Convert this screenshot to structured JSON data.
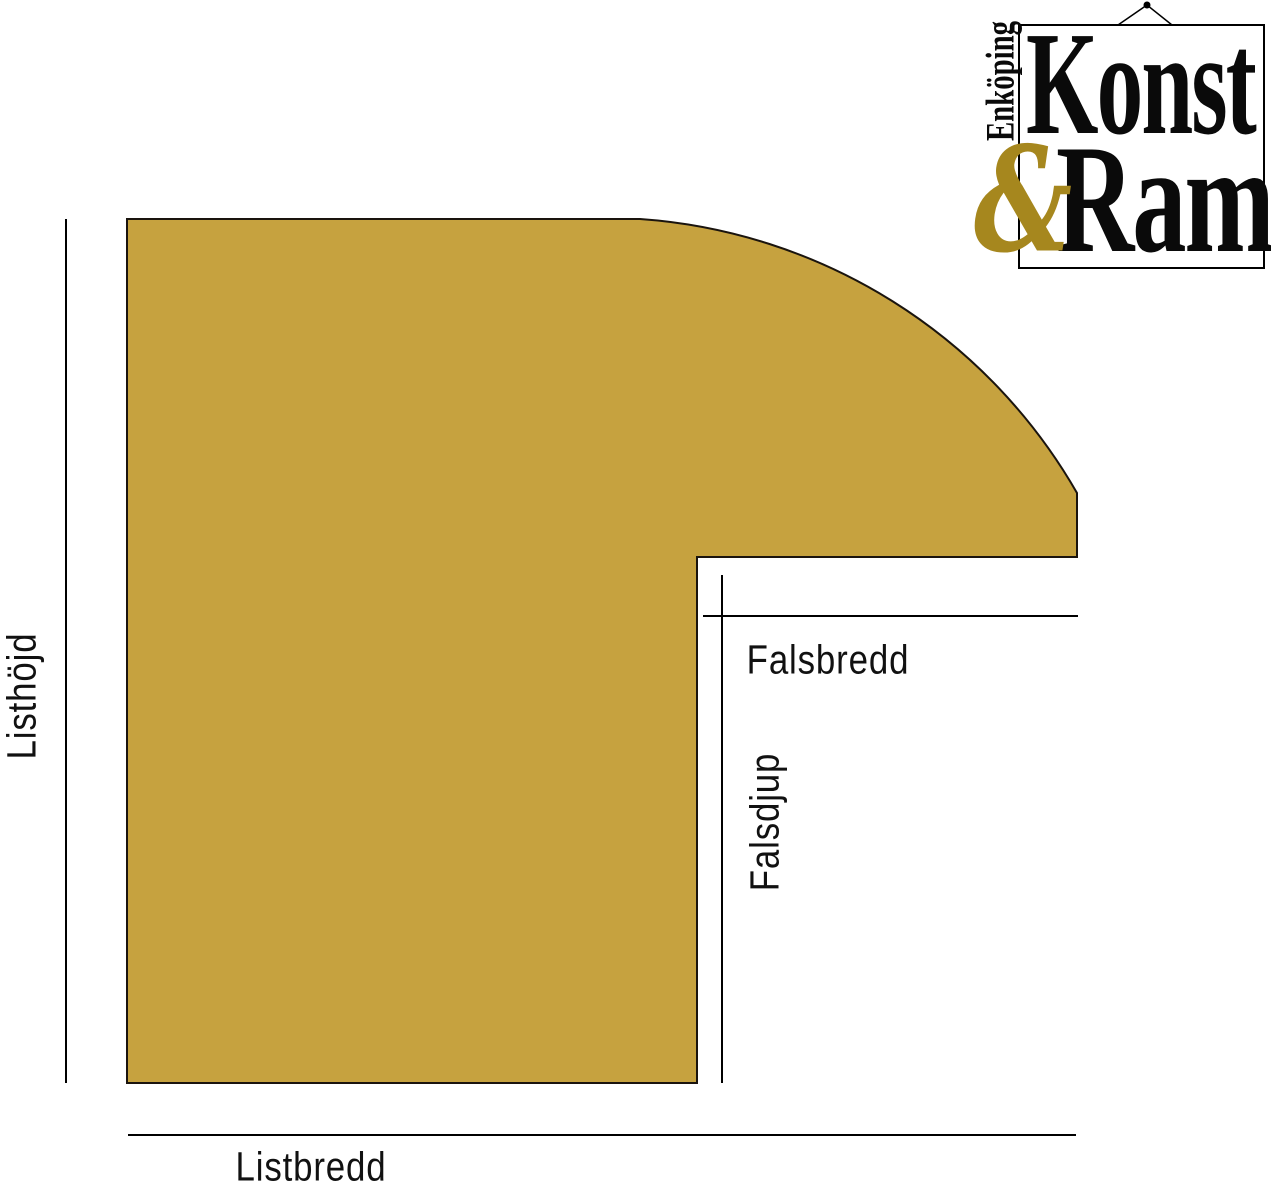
{
  "diagram": {
    "shape_color": "#C6A23F",
    "outline_color": "#1A140E",
    "line_color": "#000000",
    "text_color": "#111111",
    "labels": {
      "height": "Listhöjd",
      "width": "Listbredd",
      "rebate_width": "Falsbredd",
      "rebate_depth": "Falsdjup"
    }
  },
  "logo": {
    "city": "Enköping",
    "word1": "Konst",
    "ampersand": "&",
    "word2": "Ram",
    "text_color": "#0A0A0A",
    "ampersand_color": "#A6871E",
    "wire_color": "#000000"
  }
}
